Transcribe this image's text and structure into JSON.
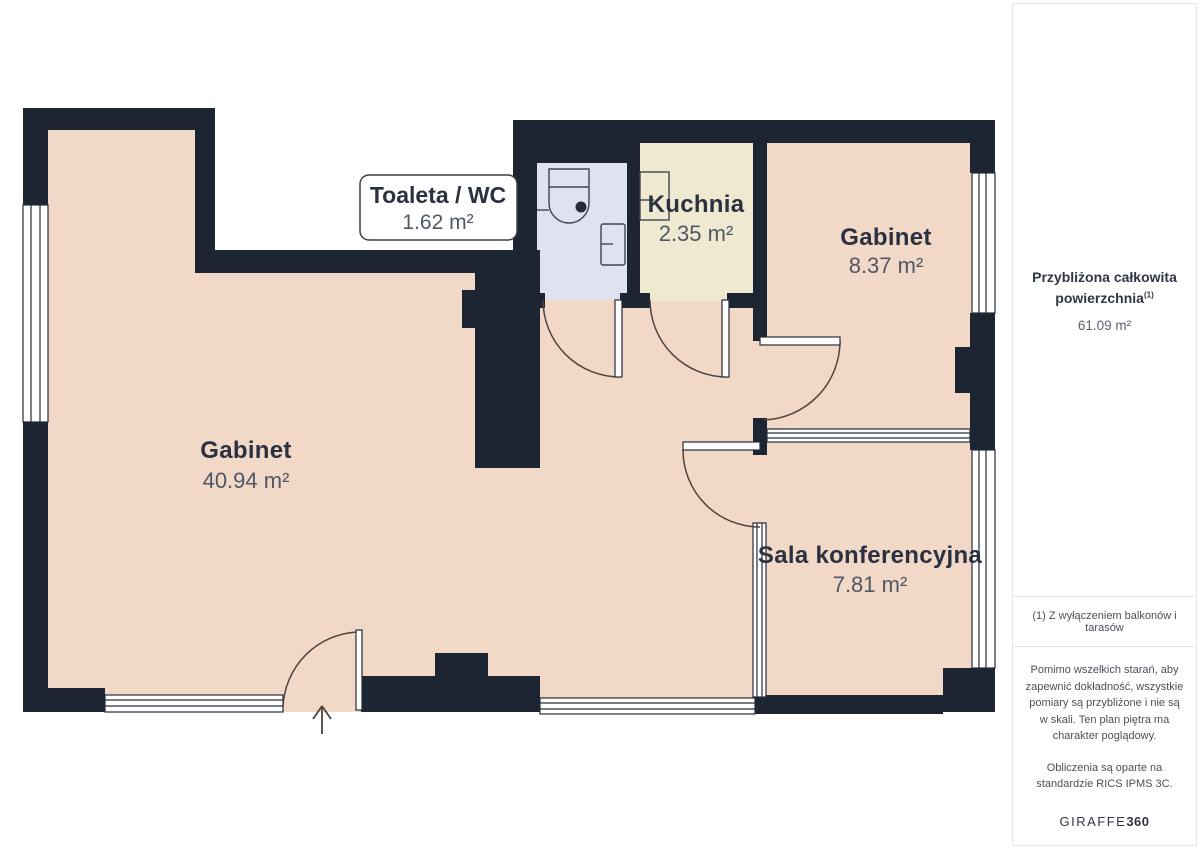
{
  "plan": {
    "rooms": [
      {
        "id": "toaleta-wc",
        "name": "Toaleta / WC",
        "area": "1.62 m²"
      },
      {
        "id": "kuchnia",
        "name": "Kuchnia",
        "area": "2.35 m²"
      },
      {
        "id": "gabinet-maly",
        "name": "Gabinet",
        "area": "8.37 m²"
      },
      {
        "id": "gabinet-duzy",
        "name": "Gabinet",
        "area": "40.94 m²"
      },
      {
        "id": "sala-konf",
        "name": "Sala konferencyjna",
        "area": "7.81 m²"
      }
    ],
    "colors": {
      "wall": "#1c2531",
      "room_salmon": "#f2d8c7",
      "room_cream": "#f0e9d1",
      "room_blue": "#dee3ef",
      "title_text": "#2a3140",
      "area_text": "#4f5866"
    }
  },
  "sidebar": {
    "total_title_line1": "Przybliżona całkowita",
    "total_title_line2": "powierzchnia",
    "total_sup": "(1)",
    "total_value": "61.09 m²",
    "footnote": "(1) Z wyłączeniem balkonów i tarasów",
    "disclaimer": "Pomimo wszelkich starań, aby zapewnić dokładność, wszystkie pomiary są przybliżone i nie są w skali. Ten plan piętra ma charakter poglądowy.",
    "standard": "Obliczenia są oparte na standardzie RICS IPMS 3C.",
    "brand_name": "GIRAFFE",
    "brand_suffix": "360"
  }
}
